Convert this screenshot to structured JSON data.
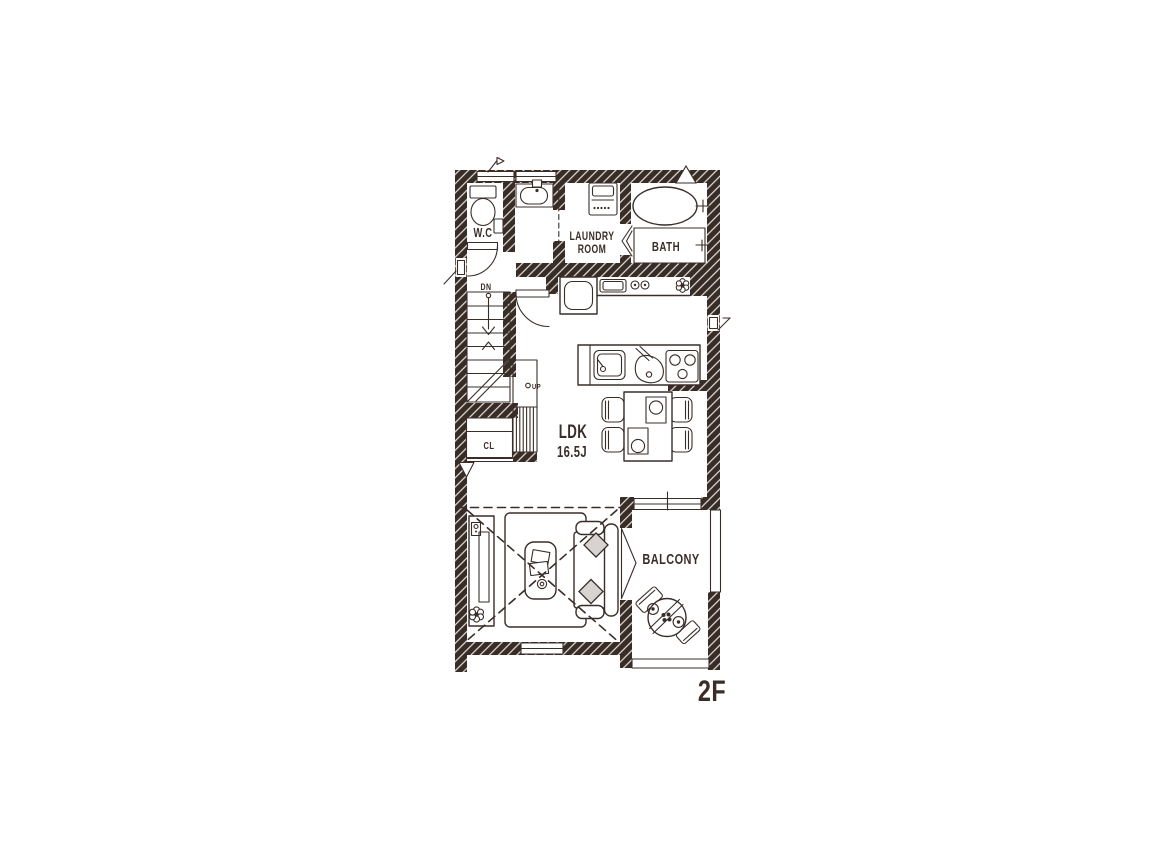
{
  "plan": {
    "floor_label": "2F",
    "labels": {
      "wc": "W.C",
      "laundry_line1": "LAUNDRY",
      "laundry_line2": "ROOM",
      "bath": "BATH",
      "ldk_line1": "LDK",
      "ldk_line2": "16.5J",
      "closet": "CL",
      "balcony": "BALCONY",
      "stairs_down": "DN",
      "stairs_up": "UP"
    },
    "colors": {
      "ink": "#3a2d28",
      "paper": "#ffffff",
      "hatch_line": "#efe9e2",
      "cushion": "#d6d3d0"
    }
  }
}
